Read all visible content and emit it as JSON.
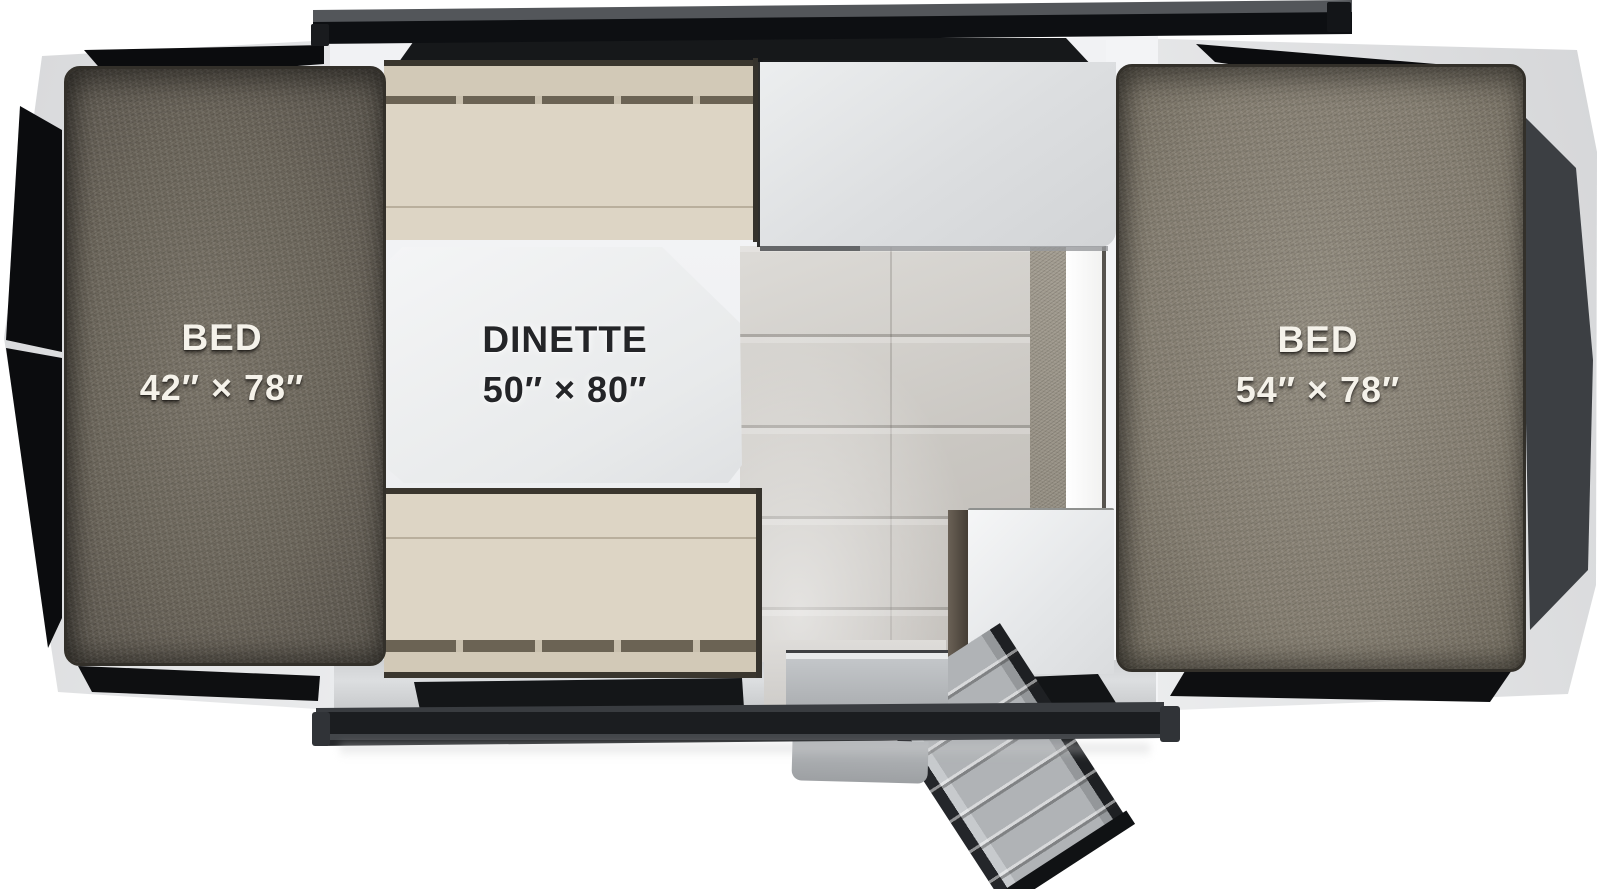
{
  "diagram": {
    "type": "rv-popup-camper-floorplan",
    "areas": {
      "bed_left": {
        "label": "BED",
        "dimensions": "42″ × 78″"
      },
      "dinette": {
        "label": "DINETTE",
        "dimensions": "50″ × 80″"
      },
      "bed_right": {
        "label": "BED",
        "dimensions": "54″ × 78″"
      }
    },
    "features": {
      "entry_step": "fold-out-entry-step",
      "galley_counter": "kitchen-counter",
      "storage_cabinet": "cabinet",
      "floor": "wood-plank-flooring"
    },
    "colors": {
      "bed_fabric_left": "#6c665b",
      "bed_fabric_right": "#867f72",
      "bench_upholstery": "#ddd5c5",
      "table_top": "#eef0f1",
      "counter_top": "#dcdee0",
      "floor_wood": "#ccc9c4",
      "trim_dark": "#16181a",
      "canvas_white": "#f1f2f3",
      "step_metal": "#b6b9bc"
    }
  }
}
